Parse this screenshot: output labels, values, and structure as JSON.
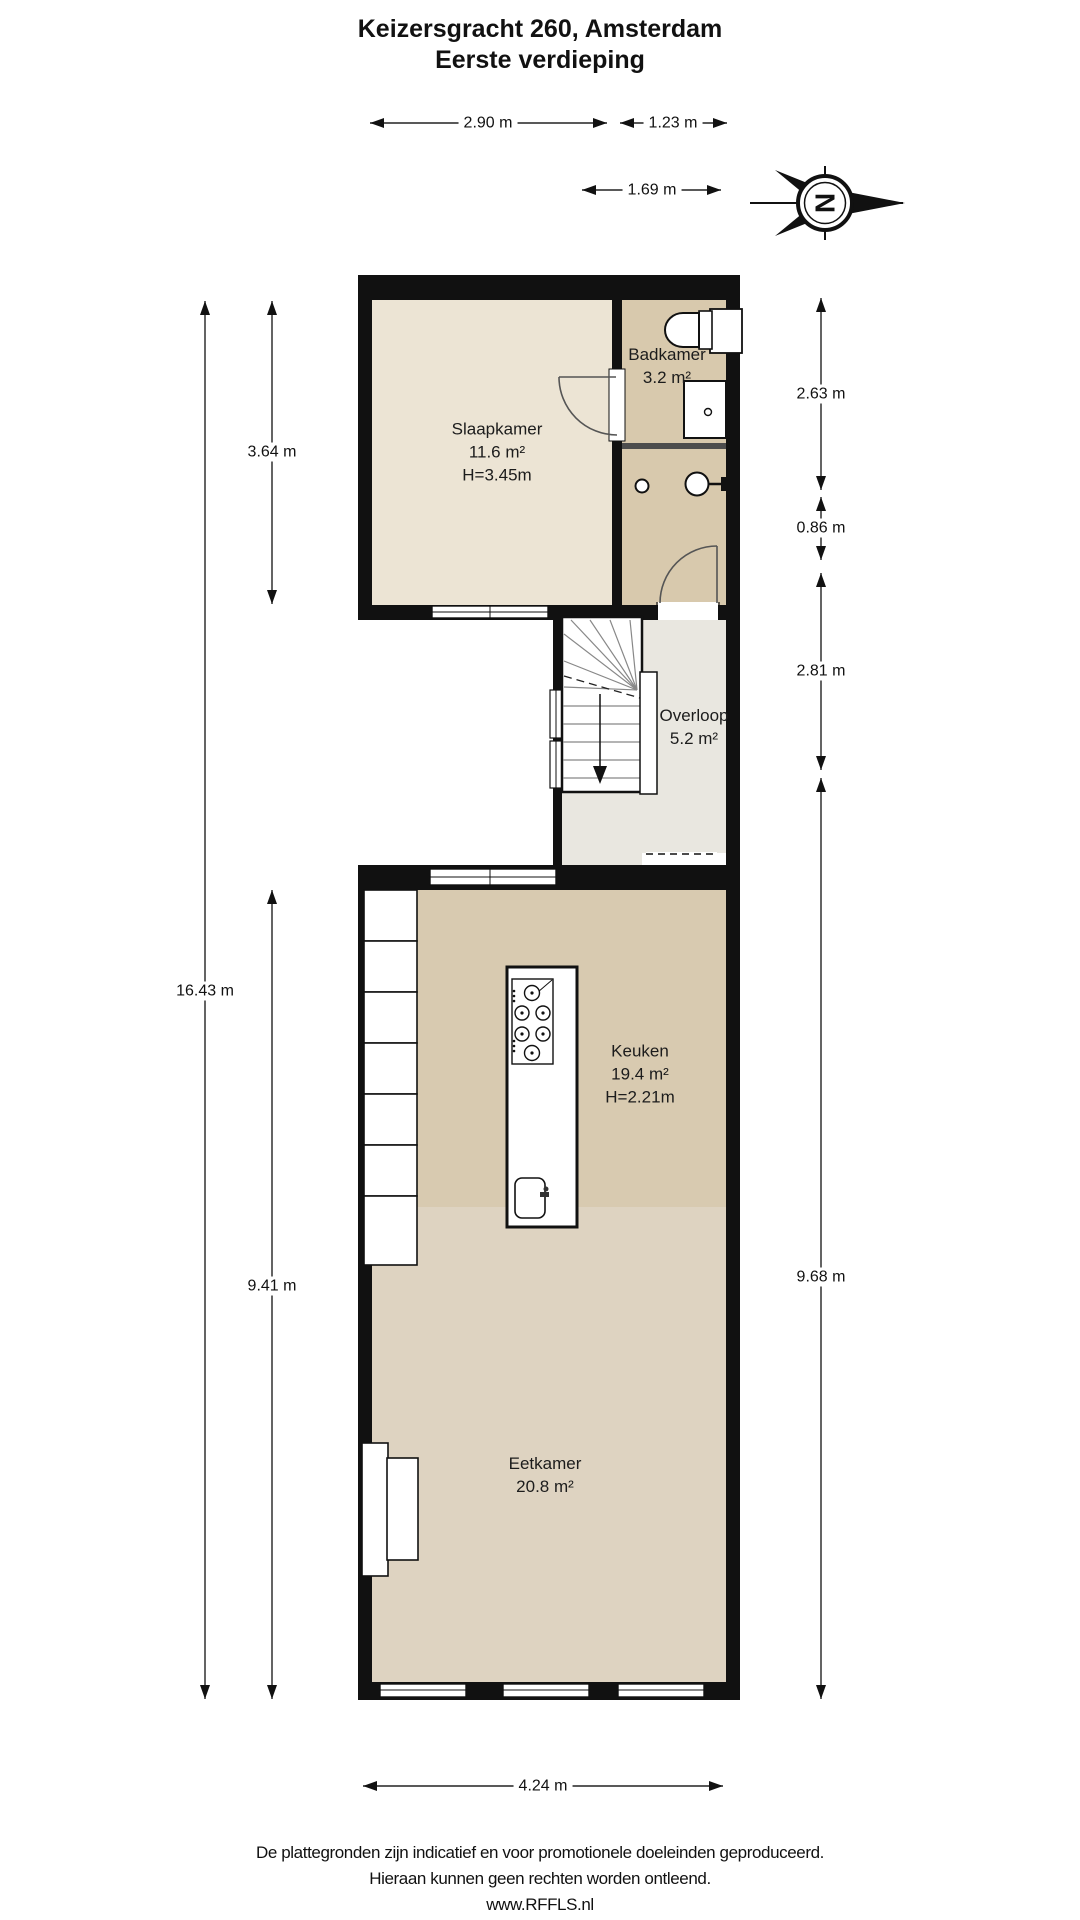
{
  "title": {
    "line1": "Keizersgracht 260, Amsterdam",
    "line2": "Eerste verdieping"
  },
  "rooms": {
    "slaapkamer": {
      "name": "Slaapkamer",
      "area": "11.6 m²",
      "height": "H=3.45m"
    },
    "badkamer": {
      "name": "Badkamer",
      "area": "3.2 m²"
    },
    "overloop": {
      "name": "Overloop",
      "area": "5.2 m²"
    },
    "keuken": {
      "name": "Keuken",
      "area": "19.4 m²",
      "height": "H=2.21m"
    },
    "eetkamer": {
      "name": "Eetkamer",
      "area": "20.8 m²"
    }
  },
  "dimensions": {
    "top_width_main": "2.90 m",
    "top_width_bath": "1.23 m",
    "top_width_landing": "1.69 m",
    "left_total": "16.43 m",
    "left_bedroom": "3.64 m",
    "left_lower": "9.41 m",
    "right_bath": "2.63 m",
    "right_gap": "0.86 m",
    "right_landing": "2.81 m",
    "right_lower": "9.68 m",
    "bottom_width": "4.24 m"
  },
  "compass": {
    "letter": "N"
  },
  "footer": {
    "line1": "De plattegronden zijn indicatief en voor promotionele doeleinden geproduceerd.",
    "line2": "Hieraan kunnen geen rechten worden ontleend.",
    "line3": "www.RFFLS.nl"
  },
  "colors": {
    "wall": "#111111",
    "slaapkamer": "#ece4d4",
    "badkamer": "#d8c9ad",
    "overloop": "#e9e7e0",
    "keuken": "#d8cab0",
    "eetkamer": "#ded3c1"
  }
}
